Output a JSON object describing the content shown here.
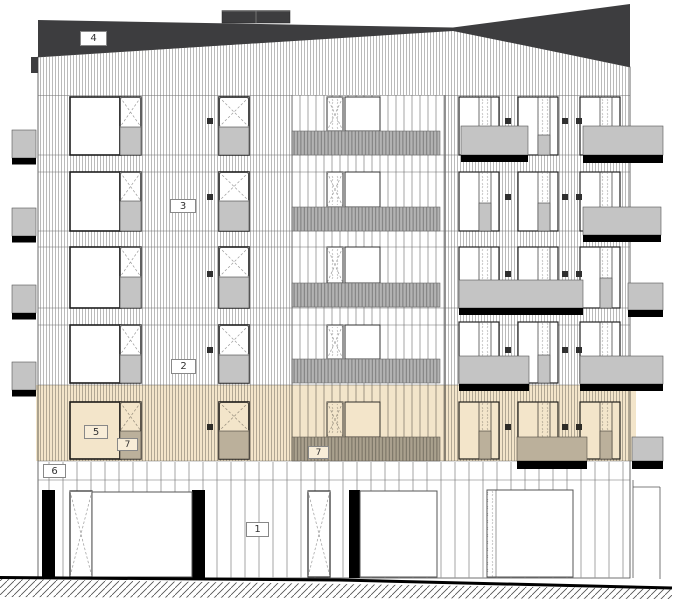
{
  "drawing": {
    "type": "architectural-elevation",
    "callouts": {
      "c1": "1",
      "c2": "2",
      "c3": "3",
      "c4": "4",
      "c5": "5",
      "c6": "6",
      "c7a": "7",
      "c7b": "7"
    },
    "colors": {
      "roof": "#3d3d3f",
      "panel": "#c4c4c4",
      "railing": "#b3b3b3",
      "highlight": "#f2e3c6",
      "slab_shadow": "#000000",
      "facade": "#ffffff",
      "vent": "#2f2f2f"
    }
  }
}
